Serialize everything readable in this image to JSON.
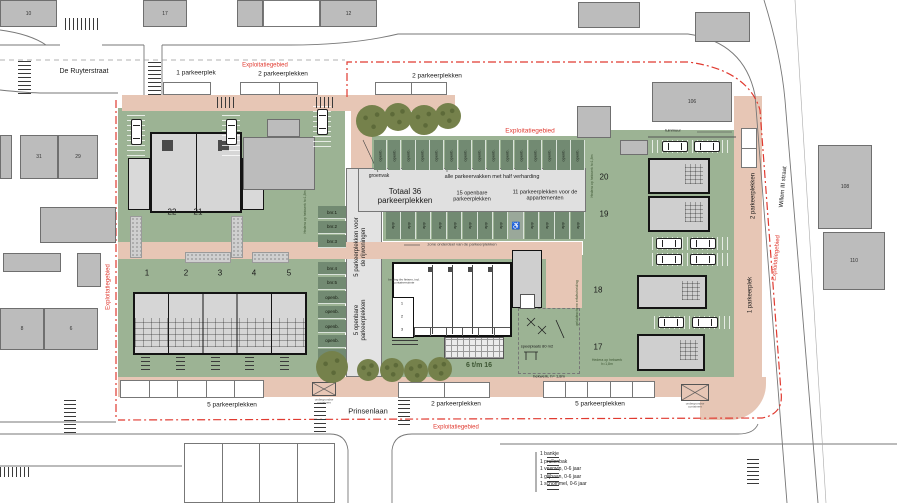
{
  "plan": {
    "streets": {
      "de_ruyterstraat": "De Ruyterstraat",
      "prinsenlaan": "Prinsenlaan",
      "willem_iii_straat": "Willem III straat"
    },
    "boundary_label": "Exploitatiegebied",
    "parking": {
      "top": [
        "1 parkeerplek",
        "2 parkeerplekken",
        "2 parkeerplekken"
      ],
      "bottom": [
        "5 parkeerplekken",
        "2 parkeerplekken",
        "5 parkeerplekken"
      ],
      "right": [
        "2 parkeerplekken",
        "1 parkeerplek"
      ],
      "strip_rijwoningen": "5 parkeerplekken voor de rijwoningen",
      "strip_openbaar": "5 openbare parkeerplekken",
      "totaal": "Totaal 36 parkeerplekken",
      "openbare": "15 openbare parkeerplekken",
      "appartementen": "11 parkeerplekken voor de appartementen",
      "groenvak": "groenvak",
      "half_verharding": "alle parkeervakken met half verharding",
      "zone": "zone onderdeel van de parkeerplekken",
      "bay_openbaar_label": "openb.",
      "bay_app_label": "app",
      "openbaar_count": 15,
      "app_count": 13,
      "wheelchair_bay_index": 8,
      "wheelchair_icon": "♿",
      "bnr_bays": [
        "bnr.1",
        "bnr.2",
        "bnr.3",
        "bnr.4",
        "bnr.5",
        "openb.",
        "openb.",
        "openb.",
        "openb.",
        "openb."
      ]
    },
    "houses": {
      "left_pair": [
        "22",
        "21"
      ],
      "row": [
        "1",
        "2",
        "3",
        "4",
        "5"
      ],
      "right_column": [
        "20",
        "19",
        "18",
        "17"
      ],
      "apartments_range": "6 t/m 16",
      "storage": [
        "1",
        "2",
        "3"
      ]
    },
    "context_building_labels": [
      "10",
      "17",
      "12",
      "",
      "",
      "",
      "106",
      "108",
      "110",
      "31",
      "29",
      "",
      "",
      "",
      "",
      "8",
      "6",
      "9",
      "7",
      "5",
      "3",
      "",
      "",
      "",
      ""
    ],
    "playground": {
      "label": "speelplaats 80 m2",
      "fence": "hekwerk, h= 1,8m",
      "legend": [
        "1 bankje",
        "1 prullenbak",
        "1 veerwip, 0-6 jaar",
        "1 glijbaan, 0-6 jaar",
        "1 schommel, 0-6 jaar"
      ]
    },
    "annotations": {
      "tuinmuur": "tuinmuur",
      "hedera": "Hedera op hekwerk h=1,8m",
      "geluidsscherm": "geluidsscherm erfafscheiding",
      "containers": "ondergrondse containers",
      "berging": "berging tbv fietsen, incl. containerruimte"
    },
    "colors": {
      "paving": "#e7c6b5",
      "grass": "#9cb394",
      "parking_bay": "#728a72",
      "tree": "#75814b",
      "context_fill": "#bcbcbc",
      "boundary_red": "#e03a30"
    }
  }
}
